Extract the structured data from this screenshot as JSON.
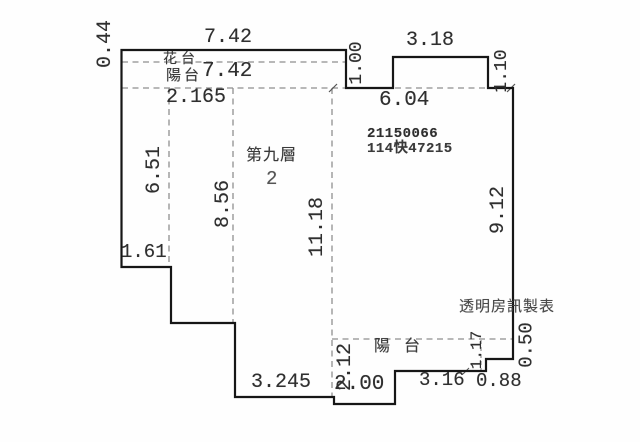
{
  "plan": {
    "floor_label": "第九層",
    "unit_number": "2",
    "registration": {
      "line1": "21150066",
      "line2": "114快47215"
    },
    "watermark": "透明房訊製表",
    "rooms": {
      "flower_bed": "花台",
      "balcony_top": "陽台",
      "balcony_bottom": "陽台"
    },
    "dims": {
      "flower_bed_depth": "0.44",
      "top_width": "7.42",
      "balcony_top_width": "7.42",
      "inner_width_left": "2.165",
      "notch_depth": "1.00",
      "upper_box_width": "3.18",
      "upper_box_depth": "1.10",
      "inner_top_width": "6.04",
      "left_height": "6.51",
      "mid_height": "8.56",
      "mid_right_height": "11.18",
      "right_height": "9.12",
      "left_step_width": "1.61",
      "bottom_width_1": "3.245",
      "balcony_bottom_depth": "2.12",
      "bottom_width_2": "2.00",
      "bottom_width_3": "3.16",
      "bottom_width_4": "0.88",
      "right_step_depth_1": "1.17",
      "right_step_depth_2": "0.50"
    }
  },
  "colors": {
    "background": "#fefefe",
    "outline": "#161616",
    "dashed_line": "#8f8f8f",
    "dimension_text": "#2f2f2f",
    "watermark_text": "#4a4a4a"
  }
}
